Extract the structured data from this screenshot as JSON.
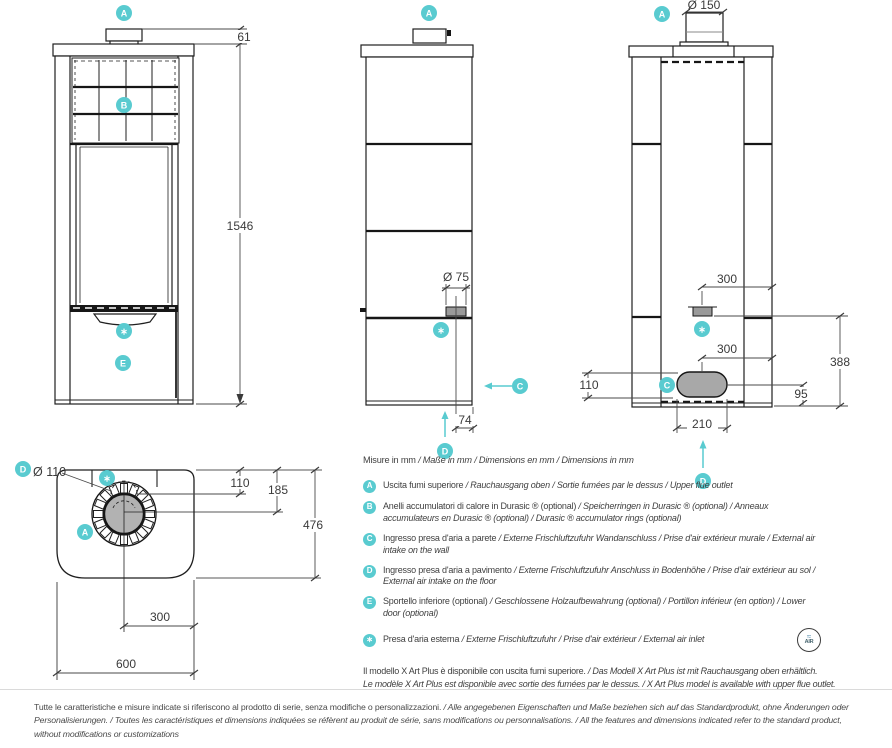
{
  "colors": {
    "accent_teal": "#59CBD0",
    "line_dark": "#1F1F1F",
    "dim_text": "#3A3A3A",
    "intake_fill_gray": "#A8A8A8"
  },
  "badges": {
    "a": "A",
    "b": "B",
    "c": "C",
    "d": "D",
    "e": "E",
    "star": "∗"
  },
  "dims": {
    "front_cap_height": "61",
    "front_total_height": "1546",
    "side_wall_intake_diam": "Ø 75",
    "side_wall_intake_offset": "74",
    "rear_flue_diam": "Ø 150",
    "rear_wall_intake_offset": "300",
    "rear_floor_intake_offset": "300",
    "rear_wall_intake_height": "388",
    "rear_floor_intake_height": "110",
    "rear_floor_intake_clearance": "95",
    "rear_floor_intake_width": "210",
    "top_floor_intake_diam": "Ø 110",
    "top_flue_to_back": "110",
    "top_flue_center": "185",
    "top_depth": "476",
    "top_flue_side": "300",
    "top_width": "600"
  },
  "legend": {
    "units": {
      "primary": "Misure in mm",
      "translations": " / Maße in mm / Dimensions en mm / Dimensions in mm"
    },
    "items": [
      {
        "key": "A",
        "primary": "Uscita fumi superiore",
        "translations": " / Rauchausgang oben  / Sortie fumées par le dessus / Upper flue outlet"
      },
      {
        "key": "B",
        "primary": "Anelli accumulatori di calore in Durasic ® (optional)",
        "translations": "  / Speicherringen in Durasic ® (optional) / Anneaux accumulateurs en Durasic ® (optional)  / Durasic ®  accumulator rings (optional)"
      },
      {
        "key": "C",
        "primary": "Ingresso presa d'aria a parete",
        "translations": " / Externe Frischluftzufuhr Wandanschluss / Prise d'air extérieur murale / External air intake on the wall"
      },
      {
        "key": "D",
        "primary": "Ingresso presa d'aria a pavimento",
        "translations": " / Externe Frischluftzufuhr Anschluss in Bodenhöhe / Prise d'air extérieur au sol / External air intake on the floor"
      },
      {
        "key": "E",
        "primary": "Sportello inferiore (optional)",
        "translations": " / Geschlossene Holzaufbewahrung (optional) / Portillon inférieur (en option) / Lower door (optional)"
      },
      {
        "key": "∗",
        "primary": "Presa d'aria esterna",
        "translations": " / Externe Frischluftzufuhr / Prise d'air extérieur / External air inlet"
      }
    ],
    "air_icon": {
      "glyph": "≈",
      "label": "AIR"
    },
    "note": {
      "primary": "Il modello X Art Plus è disponibile con uscita fumi superiore.",
      "translations": " / Das Modell X Art Plus ist mit Rauchausgang oben erhältlich.",
      "line2": "Le modèle X Art Plus est disponible avec sortie des fumées par le dessus. / X Art Plus model is available with upper flue outlet."
    }
  },
  "footer": {
    "primary": "Tutte le caratteristiche e misure indicate si riferiscono al prodotto di serie, senza modifiche o personalizzazioni.",
    "translations": " / Alle angegebenen Eigenschaften und Maße beziehen sich auf das Standardprodukt, ohne Änderungen oder Personalisierungen. / Toutes les caractéristiques et dimensions indiquées se réfèrent au produit de série, sans modifications ou personnalisations. / All the features and dimensions indicated refer to the standard product, without modifications or customizations"
  }
}
